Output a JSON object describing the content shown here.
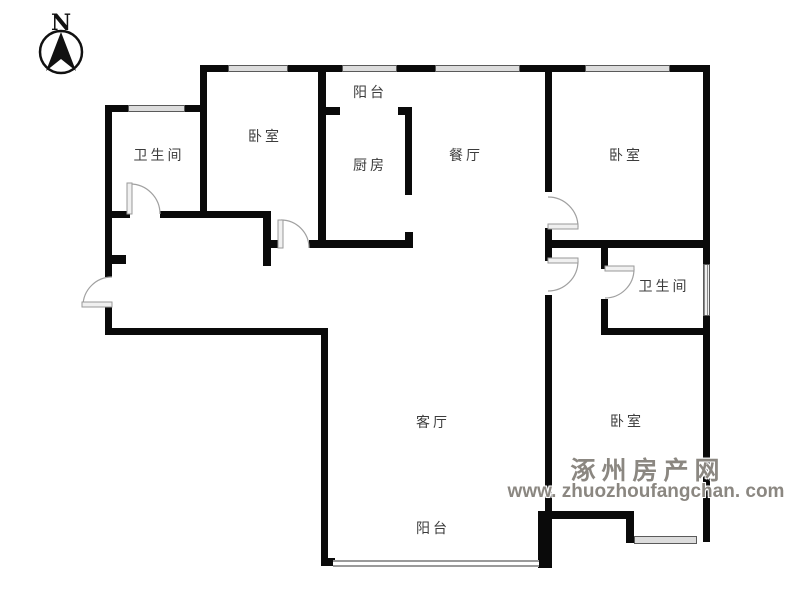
{
  "compass": {
    "label": "N"
  },
  "rooms": {
    "bathroom1": {
      "label": "卫生间"
    },
    "bedroom1": {
      "label": "卧室"
    },
    "balcony_top": {
      "label": "阳台"
    },
    "kitchen": {
      "label": "厨房"
    },
    "dining": {
      "label": "餐厅"
    },
    "bedroom2": {
      "label": "卧室"
    },
    "bathroom2": {
      "label": "卫生间"
    },
    "living": {
      "label": "客厅"
    },
    "bedroom3": {
      "label": "卧室"
    },
    "balcony_bottom": {
      "label": "阳台"
    }
  },
  "watermark": {
    "line1": "涿州房产网",
    "line2": "www. zhuozhoufangchan. com"
  },
  "colors": {
    "wall": "#0a0a0a",
    "window_fill": "#dcdcdc",
    "door_stroke": "#a0a0a0",
    "label_text": "#3c3c3c",
    "watermark_gray": "#8b8781"
  }
}
